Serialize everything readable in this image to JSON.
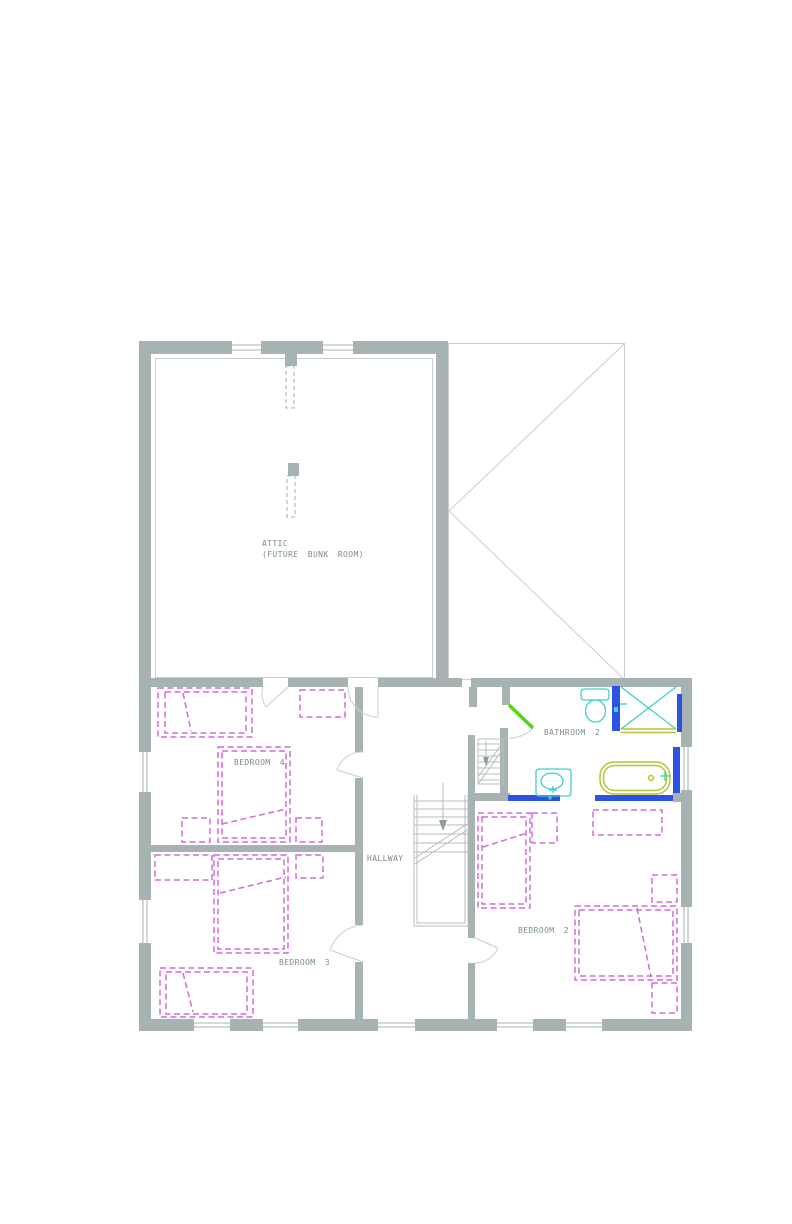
{
  "drawing": {
    "type": "floor-plan",
    "rooms": [
      {
        "id": "attic",
        "label": "ATTIC",
        "sublabel": "(FUTURE BUNK ROOM)"
      },
      {
        "id": "bedroom-4",
        "label": "BEDROOM 4"
      },
      {
        "id": "hallway",
        "label": "HALLWAY"
      },
      {
        "id": "bathroom-2",
        "label": "BATHROOM 2"
      },
      {
        "id": "bedroom-3",
        "label": "BEDROOM 3"
      },
      {
        "id": "bedroom-2",
        "label": "BEDROOM 2"
      }
    ],
    "fixtures": [
      "toilet",
      "shower",
      "bath",
      "basin"
    ],
    "colors": {
      "wall_gray": "#a7b3b2",
      "label_gray": "#7a8c8b",
      "furniture_magenta": "#d26ad8",
      "fixture_cyan": "#3fd0c8",
      "tile_blue": "#2b55e0",
      "fitting_olive": "#b8c435",
      "door_green": "#55d414"
    }
  }
}
